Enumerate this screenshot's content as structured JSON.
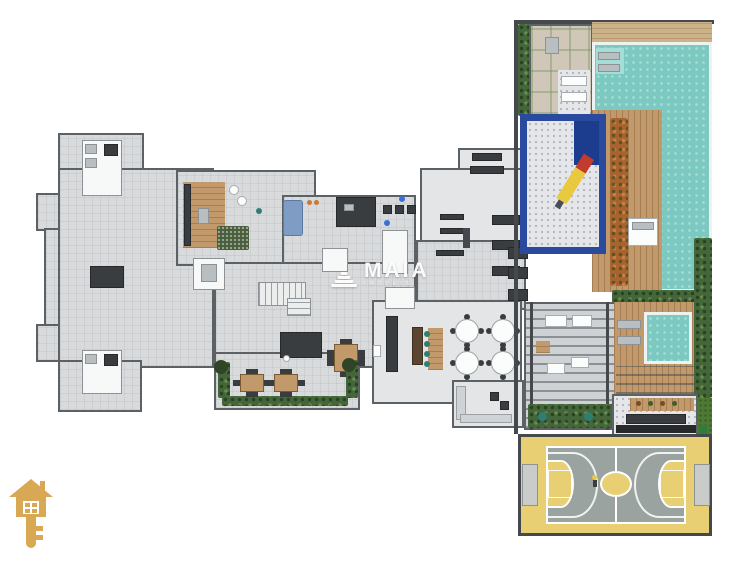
{
  "canvas": {
    "width": 750,
    "height": 564,
    "background": "#ffffff"
  },
  "watermark": {
    "brand": "MAIA",
    "subtext": "IMÓVEIS",
    "icon": "dome-layers-icon",
    "color": "#ffffff"
  },
  "logo": {
    "icon": "house-key-icon",
    "color": "#d9a855"
  },
  "colors": {
    "floor": "#d8dadc",
    "floor2": "#e3e5e6",
    "wall": "#5c6165",
    "wallD": "#45494d",
    "wood": "#c2996a",
    "woodL": "#ccb289",
    "pool": "#7cc9c1",
    "poolL": "#a5ded6",
    "hedge": "#45663a",
    "grass": "#4e7a36",
    "stone": "#d0c7b9",
    "mat": "#e4e6e9",
    "blue": "#2a4a9f",
    "navy": "#1c3c8e",
    "yellow": "#e9cf74",
    "courtGray": "#9ba3a1",
    "rug": "#4a5f3e",
    "sofa": "#7e9cc4",
    "teal": "#2f7e74",
    "dark": "#3a3d40",
    "rust": "#a9632f",
    "gold": "#d9a855"
  }
}
